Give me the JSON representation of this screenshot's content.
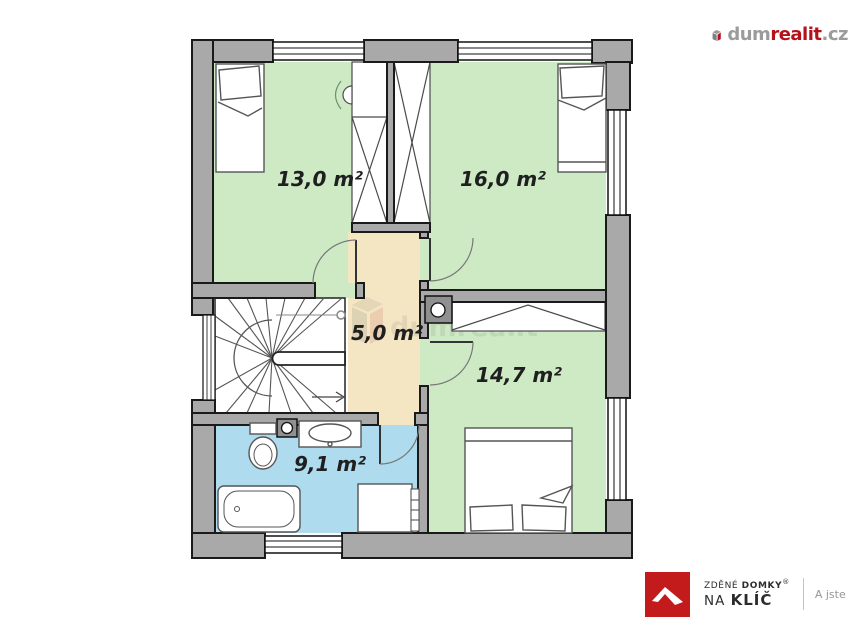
{
  "floor_plan": {
    "rooms": [
      {
        "name": "bedroom-upper-left",
        "area_label": "13,0 m²",
        "fill": "#cdeac5"
      },
      {
        "name": "bedroom-upper-right",
        "area_label": "16,0 m²",
        "fill": "#cdeac5"
      },
      {
        "name": "hallway",
        "area_label": "5,0 m²",
        "fill": "#f4e6c3"
      },
      {
        "name": "bedroom-lower-right",
        "area_label": "14,7 m²",
        "fill": "#cdeac5"
      },
      {
        "name": "bathroom",
        "area_label": "9,1 m²",
        "fill": "#aedcee"
      }
    ],
    "wall_color": "#a9a9a9",
    "watermark_text": "dumrealit"
  },
  "branding": {
    "top_right_logo": {
      "part_gray1": "dum",
      "part_red": "realit",
      "part_gray2": ".cz",
      "red": "#b5121b",
      "gray": "#9b9b9b"
    },
    "bottom_right_logo": {
      "line1_regular": "ZDĚNÉ ",
      "line1_bold": "DOMKY",
      "registered_mark": "®",
      "line2_regular": "NA ",
      "line2_bold": "KLÍČ",
      "tagline": "A jste dom",
      "red": "#c31b1b"
    }
  }
}
